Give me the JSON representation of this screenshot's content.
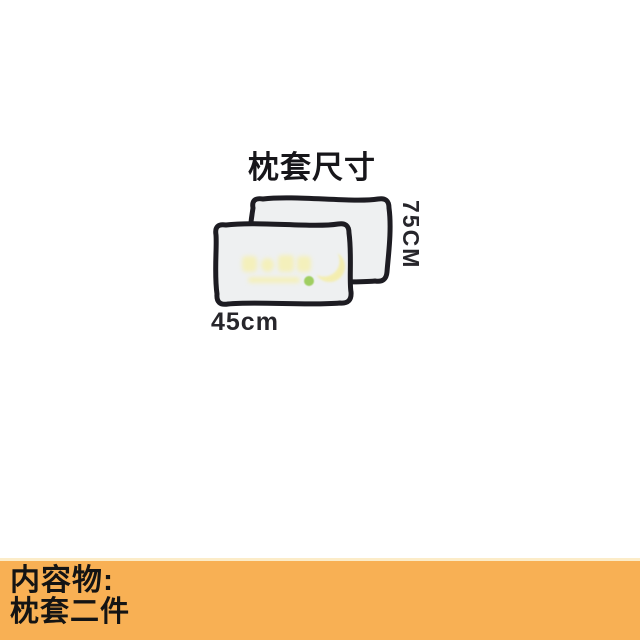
{
  "page": {
    "background": "#ffffff"
  },
  "diagram": {
    "title": "枕套尺寸",
    "width_label": "45cm",
    "height_label": "75CM",
    "pillow_count": 2,
    "pillow_fill": "#eef0f1",
    "outline_color": "#1d1c22",
    "label_color": "#27262b"
  },
  "watermark": {
    "glyph_color": "#f6f0ae",
    "moon_color": "#f5eda0",
    "dot_color": "#8cc63e"
  },
  "footer": {
    "background": "#f8b054",
    "heading": "内容物:",
    "content": "枕套二件",
    "text_color": "#141414"
  }
}
